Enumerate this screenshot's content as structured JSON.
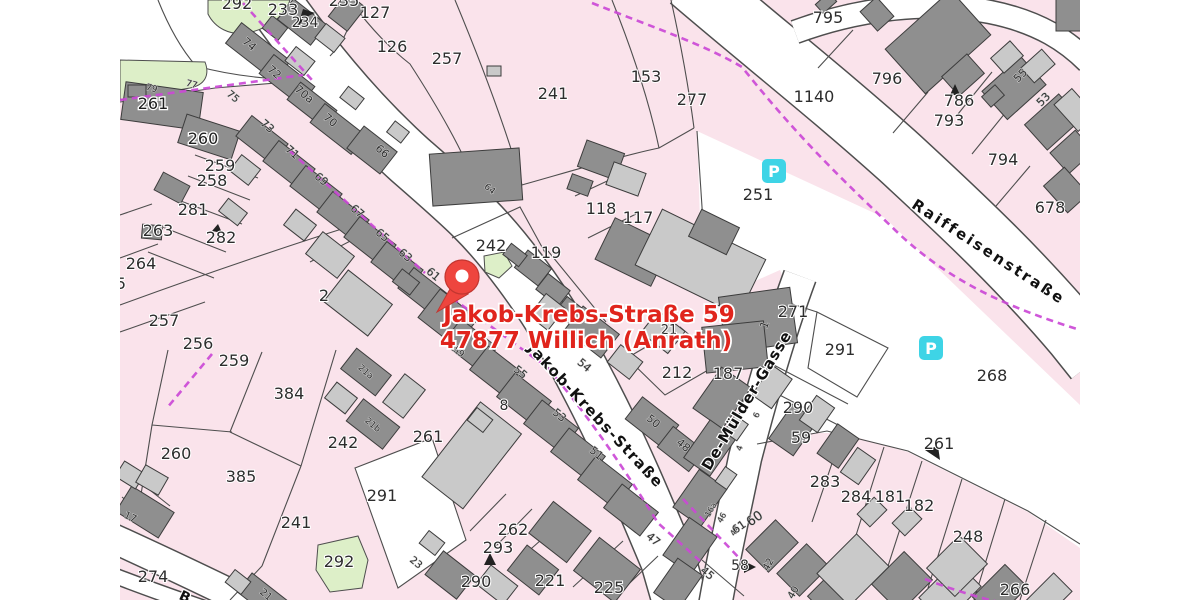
{
  "map": {
    "address_marker": {
      "line1": "Jakob-Krebs-Straße 59",
      "line2": "47877 Willich (Anrath)",
      "color": "#e0241c"
    },
    "street_labels": [
      {
        "t": "Jakob-Krebs-Straße",
        "x": 592,
        "y": 419,
        "rot": 47,
        "s": 15,
        "ls": 1.5
      },
      {
        "t": "De-Mülder-Gasse",
        "x": 751,
        "y": 403,
        "rot": -59,
        "s": 15,
        "ls": 1
      },
      {
        "t": "Raiffeisenstraße",
        "x": 986,
        "y": 256,
        "rot": 33,
        "s": 15,
        "ls": 2.5
      },
      {
        "t": "B",
        "x": 183,
        "y": 601,
        "rot": 25,
        "s": 14
      }
    ],
    "parcel_labels": [
      {
        "t": "292",
        "x": 237,
        "y": 9
      },
      {
        "t": "233",
        "x": 283,
        "y": 15
      },
      {
        "t": "234",
        "x": 305,
        "y": 27,
        "s": 14
      },
      {
        "t": "235",
        "x": 344,
        "y": 6
      },
      {
        "t": "127",
        "x": 375,
        "y": 18
      },
      {
        "t": "126",
        "x": 392,
        "y": 52
      },
      {
        "t": "257",
        "x": 447,
        "y": 64
      },
      {
        "t": "241",
        "x": 553,
        "y": 99
      },
      {
        "t": "153",
        "x": 646,
        "y": 82
      },
      {
        "t": "277",
        "x": 692,
        "y": 105
      },
      {
        "t": "1140",
        "x": 814,
        "y": 102
      },
      {
        "t": "795",
        "x": 828,
        "y": 23
      },
      {
        "t": "796",
        "x": 887,
        "y": 84
      },
      {
        "t": "786",
        "x": 959,
        "y": 106
      },
      {
        "t": "793",
        "x": 949,
        "y": 126
      },
      {
        "t": "794",
        "x": 1003,
        "y": 165
      },
      {
        "t": "678",
        "x": 1050,
        "y": 213
      },
      {
        "t": "261",
        "x": 153,
        "y": 109,
        "c": "w"
      },
      {
        "t": "260",
        "x": 203,
        "y": 144,
        "c": "w"
      },
      {
        "t": "259",
        "x": 220,
        "y": 171
      },
      {
        "t": "258",
        "x": 212,
        "y": 186
      },
      {
        "t": "281",
        "x": 193,
        "y": 215
      },
      {
        "t": "263",
        "x": 158,
        "y": 236
      },
      {
        "t": "282",
        "x": 221,
        "y": 243
      },
      {
        "t": "264",
        "x": 141,
        "y": 269
      },
      {
        "t": "5",
        "x": 121,
        "y": 289
      },
      {
        "t": "257",
        "x": 164,
        "y": 326
      },
      {
        "t": "256",
        "x": 198,
        "y": 349
      },
      {
        "t": "2",
        "x": 324,
        "y": 301
      },
      {
        "t": "242",
        "x": 491,
        "y": 251
      },
      {
        "t": "119",
        "x": 546,
        "y": 258
      },
      {
        "t": "118",
        "x": 601,
        "y": 214
      },
      {
        "t": "117",
        "x": 638,
        "y": 223
      },
      {
        "t": "251",
        "x": 758,
        "y": 200
      },
      {
        "t": "271",
        "x": 793,
        "y": 317
      },
      {
        "t": "291",
        "x": 840,
        "y": 355
      },
      {
        "t": "268",
        "x": 992,
        "y": 381
      },
      {
        "t": "212",
        "x": 677,
        "y": 378
      },
      {
        "t": "187",
        "x": 728,
        "y": 379
      },
      {
        "t": "21",
        "x": 669,
        "y": 334,
        "s": 13
      },
      {
        "t": "259",
        "x": 234,
        "y": 366
      },
      {
        "t": "384",
        "x": 289,
        "y": 399
      },
      {
        "t": "242",
        "x": 343,
        "y": 448
      },
      {
        "t": "261",
        "x": 428,
        "y": 442
      },
      {
        "t": "260",
        "x": 176,
        "y": 459
      },
      {
        "t": "385",
        "x": 241,
        "y": 482
      },
      {
        "t": "241",
        "x": 296,
        "y": 528
      },
      {
        "t": "291",
        "x": 382,
        "y": 501
      },
      {
        "t": "292",
        "x": 339,
        "y": 567
      },
      {
        "t": "274",
        "x": 153,
        "y": 582
      },
      {
        "t": "8",
        "x": 504,
        "y": 410,
        "s": 14
      },
      {
        "t": "262",
        "x": 513,
        "y": 535
      },
      {
        "t": "293",
        "x": 498,
        "y": 553
      },
      {
        "t": "290",
        "x": 476,
        "y": 587
      },
      {
        "t": "221",
        "x": 550,
        "y": 586
      },
      {
        "t": "225",
        "x": 609,
        "y": 593
      },
      {
        "t": "290",
        "x": 798,
        "y": 413
      },
      {
        "t": "59",
        "x": 801,
        "y": 443
      },
      {
        "t": "283",
        "x": 825,
        "y": 487
      },
      {
        "t": "284",
        "x": 856,
        "y": 502
      },
      {
        "t": "181",
        "x": 890,
        "y": 502
      },
      {
        "t": "182",
        "x": 919,
        "y": 511
      },
      {
        "t": "248",
        "x": 968,
        "y": 542
      },
      {
        "t": "266",
        "x": 1015,
        "y": 595
      },
      {
        "t": "261",
        "x": 939,
        "y": 449
      },
      {
        "t": "58",
        "x": 740,
        "y": 570,
        "s": 14
      }
    ],
    "house_numbers": [
      {
        "t": "74",
        "x": 247,
        "y": 47,
        "r": 40
      },
      {
        "t": "72",
        "x": 272,
        "y": 75,
        "r": 40
      },
      {
        "t": "70a",
        "x": 302,
        "y": 97,
        "r": 40
      },
      {
        "t": "70",
        "x": 328,
        "y": 123,
        "r": 40
      },
      {
        "t": "66",
        "x": 380,
        "y": 154,
        "r": 40
      },
      {
        "t": "64",
        "x": 488,
        "y": 191,
        "r": 40,
        "s": 9
      },
      {
        "t": "79",
        "x": 151,
        "y": 91,
        "r": 15,
        "s": 9
      },
      {
        "t": "77",
        "x": 191,
        "y": 87,
        "r": 15,
        "s": 9
      },
      {
        "t": "75",
        "x": 231,
        "y": 99,
        "r": 40,
        "s": 10
      },
      {
        "t": "73",
        "x": 265,
        "y": 129,
        "r": 40
      },
      {
        "t": "71",
        "x": 290,
        "y": 155,
        "r": 40
      },
      {
        "t": "69",
        "x": 319,
        "y": 182,
        "r": 40
      },
      {
        "t": "67",
        "x": 355,
        "y": 214,
        "r": 40
      },
      {
        "t": "65",
        "x": 380,
        "y": 238,
        "r": 40
      },
      {
        "t": "63",
        "x": 403,
        "y": 258,
        "r": 40
      },
      {
        "t": "61",
        "x": 431,
        "y": 277,
        "r": 40
      },
      {
        "t": "59",
        "x": 457,
        "y": 354,
        "r": 40,
        "s": 9
      },
      {
        "t": "55",
        "x": 518,
        "y": 375,
        "r": 40
      },
      {
        "t": "53",
        "x": 557,
        "y": 418,
        "r": 40
      },
      {
        "t": "51",
        "x": 594,
        "y": 456,
        "r": 40
      },
      {
        "t": "54",
        "x": 582,
        "y": 368,
        "r": 40
      },
      {
        "t": "50",
        "x": 651,
        "y": 424,
        "r": 40
      },
      {
        "t": "48",
        "x": 681,
        "y": 448,
        "r": 40
      },
      {
        "t": "47",
        "x": 651,
        "y": 542,
        "r": 40
      },
      {
        "t": "45",
        "x": 705,
        "y": 576,
        "r": 40
      },
      {
        "t": "23",
        "x": 414,
        "y": 565,
        "r": 40,
        "s": 10
      },
      {
        "t": "21",
        "x": 264,
        "y": 597,
        "r": 40,
        "s": 10
      },
      {
        "t": "21a",
        "x": 364,
        "y": 374,
        "r": 40,
        "s": 9,
        "c": "w"
      },
      {
        "t": "21b",
        "x": 371,
        "y": 427,
        "r": 40,
        "s": 9,
        "c": "w"
      },
      {
        "t": "17",
        "x": 129,
        "y": 520,
        "r": 25,
        "s": 10,
        "c": "w"
      },
      {
        "t": "1",
        "x": 768,
        "y": 326,
        "r": -70
      },
      {
        "t": "16a",
        "x": 713,
        "y": 511,
        "r": -60,
        "s": 8
      },
      {
        "t": "46",
        "x": 724,
        "y": 519,
        "r": -60,
        "s": 8
      },
      {
        "t": "44",
        "x": 737,
        "y": 532,
        "r": -60,
        "s": 8
      },
      {
        "t": "42",
        "x": 771,
        "y": 566,
        "r": -60,
        "s": 10
      },
      {
        "t": "40",
        "x": 796,
        "y": 594,
        "r": -60,
        "s": 10
      },
      {
        "t": "60",
        "x": 757,
        "y": 522,
        "r": -35,
        "s": 13
      },
      {
        "t": "61",
        "x": 741,
        "y": 530,
        "r": -35,
        "s": 11
      },
      {
        "t": "55",
        "x": 1023,
        "y": 78,
        "r": -45
      },
      {
        "t": "53",
        "x": 1046,
        "y": 102,
        "r": -45
      },
      {
        "t": "4",
        "x": 742,
        "y": 449,
        "r": -70,
        "s": 8
      },
      {
        "t": "6",
        "x": 759,
        "y": 416,
        "r": -70,
        "s": 8
      }
    ],
    "poi_icons": [
      {
        "type": "parking",
        "label": "P",
        "x": 762,
        "y": 159
      },
      {
        "type": "parking",
        "label": "P",
        "x": 919,
        "y": 336
      }
    ],
    "colors": {
      "parcel_pink": "#fae3eb",
      "road_white": "#ffffff",
      "building_dark": "#8f8f8f",
      "building_light": "#c9c9c9",
      "outline": "#3c3c3c",
      "boundary_gray": "#4e4e4e",
      "boundary_magenta": "#cb49d6",
      "green_area": "#ddefc8",
      "parking_cyan": "#3ed4e6",
      "marker_red": "#ee453e",
      "label_red": "#e0241c"
    }
  }
}
